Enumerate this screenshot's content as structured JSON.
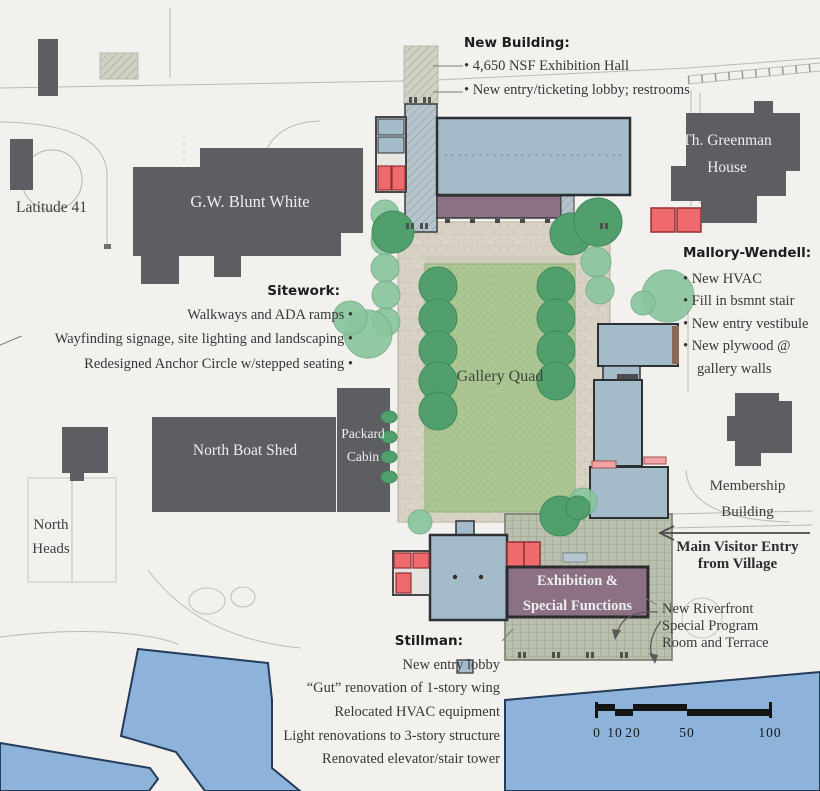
{
  "colors": {
    "building_dark": "#5c5e61",
    "building_blue": "#a4bbc9",
    "renovation_red": "#ef6a6c",
    "exhibition_purple": "#8c7083",
    "lawn_green": "#abc593",
    "tree_green": "#519f6c",
    "tree_green_light": "#8ac59e",
    "paving_tan": "#d9d3c6",
    "terrace_sage": "#bac0ae",
    "water_blue": "#8db3da",
    "ink": "#3a3a3a"
  },
  "annotations": {
    "new_building": {
      "heading": "New Building:",
      "items": [
        "• 4,650 NSF Exhibition Hall",
        "• New entry/ticketing lobby; restrooms"
      ]
    },
    "sitework": {
      "heading": "Sitework:",
      "items": [
        "Walkways and ADA ramps •",
        "Wayfinding signage, site lighting and landscaping •",
        "Redesigned Anchor Circle w/stepped seating •"
      ]
    },
    "mallory_wendell": {
      "heading": "Mallory-Wendell:",
      "items": [
        "• New HVAC",
        "• Fill in bsmnt stair",
        "• New entry vestibule",
        "• New plywood @ gallery walls"
      ]
    },
    "stillman": {
      "heading": "Stillman:",
      "items": [
        "New entry lobby",
        "“Gut” renovation of 1-story wing",
        "Relocated HVAC equipment",
        "Light renovations to 3-story structure",
        "Renovated elevator/stair tower"
      ]
    },
    "visitor_entry": {
      "line1": "Main Visitor Entry",
      "line2": "from Village"
    },
    "riverfront": {
      "line1": "New Riverfront",
      "line2": "Special Program",
      "line3": "Room and Terrace"
    }
  },
  "map_labels": {
    "latitude41": "Latitude 41",
    "gw_blunt_white": "G.W. Blunt White",
    "greenman1": "Th. Greenman",
    "greenman2": "House",
    "north_boat_shed": "North Boat Shed",
    "packard1": "Packard",
    "packard2": "Cabin",
    "gallery_quad": "Gallery Quad",
    "north_heads1": "North",
    "north_heads2": "Heads",
    "membership1": "Membership",
    "membership2": "Building",
    "exhibition1": "Exhibition &",
    "exhibition2": "Special Functions"
  },
  "scale_bar": {
    "labels": [
      "0",
      "10",
      "20",
      "50",
      "100"
    ]
  }
}
